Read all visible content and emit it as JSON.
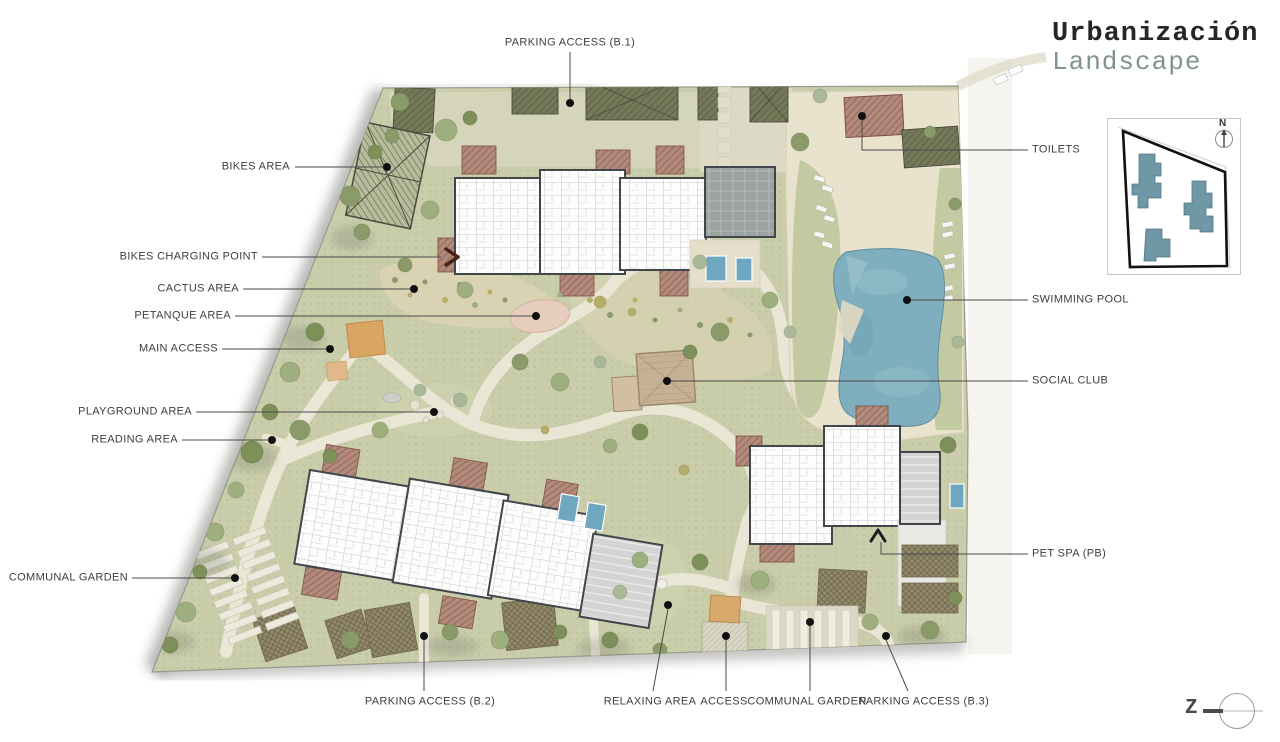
{
  "title": {
    "line1": "Urbanización",
    "line2": "Landscape"
  },
  "keymap": {
    "north": "N"
  },
  "logo": {
    "mark": "Z"
  },
  "callouts": {
    "parking_b1": "PARKING ACCESS (B.1)",
    "bikes_area": "BIKES AREA",
    "bikes_charging": "BIKES CHARGING POINT",
    "cactus": "CACTUS AREA",
    "petanque": "PETANQUE AREA",
    "main_access": "MAIN ACCESS",
    "playground": "PLAYGROUND AREA",
    "reading": "READING AREA",
    "communal_left": "COMMUNAL GARDEN",
    "toilets": "TOILETS",
    "pool": "SWIMMING POOL",
    "social_club": "SOCIAL CLUB",
    "pet_spa": "PET SPA (PB)",
    "parking_b2": "PARKING ACCESS (B.2)",
    "relaxing": "RELAXING AREA",
    "access": "ACCESS",
    "communal_right": "COMMUNAL GARDEN",
    "parking_b3": "PARKING ACCESS (B.3)"
  },
  "colors": {
    "title_accent": "#7f948e",
    "site_green": "#c9cdaa",
    "pool_blue": "#7fafbe",
    "keymap_building": "#6f98a7",
    "deck_brown": "#b28a7c"
  }
}
